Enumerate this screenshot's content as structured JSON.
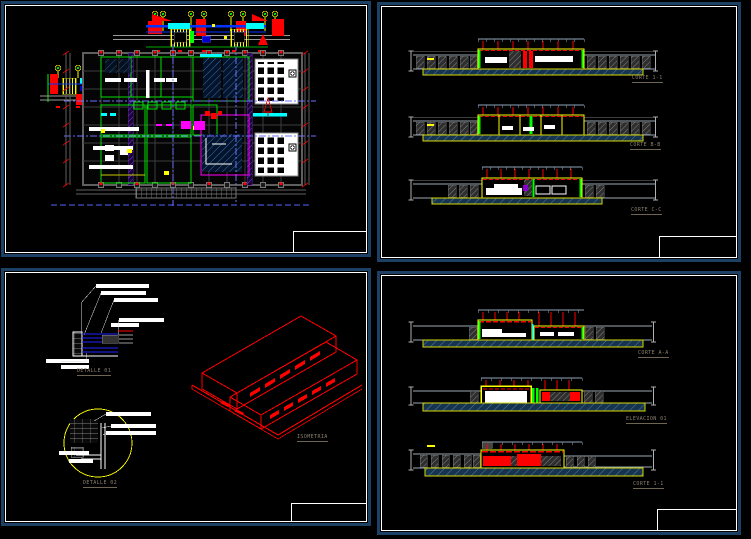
{
  "canvas": {
    "type": "cad-paper-space",
    "background": "#000000"
  },
  "palette": {
    "sheet_border_blue": "#1d4164",
    "frame_white": "#ffffff",
    "cad_red": "#ff0000",
    "cad_yellow": "#ffff00",
    "cad_green": "#00ff00",
    "cad_cyan": "#00ffff",
    "cad_blue": "#0033ff",
    "cad_magenta": "#ff00ff",
    "cad_gray": "#8fa3b8",
    "ground_hatch_blue": "#16344e",
    "label_gray": "#8b8170"
  },
  "sheets": {
    "plan": {
      "description": "floor plan with facade elevations"
    },
    "top_right": {
      "sections": [
        {
          "label": "CORTE 1-1"
        },
        {
          "label": "CORTE B-B"
        },
        {
          "label": "CORTE C-C"
        }
      ]
    },
    "bottom_left": {
      "details": [
        {
          "label": "DETALLE 01"
        },
        {
          "label": "DETALLE 02"
        }
      ],
      "isometric_label": "ISOMETRIA"
    },
    "bottom_right": {
      "sections": [
        {
          "label": "CORTE A-A"
        },
        {
          "label": "ELEVACION 01"
        },
        {
          "label": "CORTE 1-1"
        }
      ]
    }
  }
}
